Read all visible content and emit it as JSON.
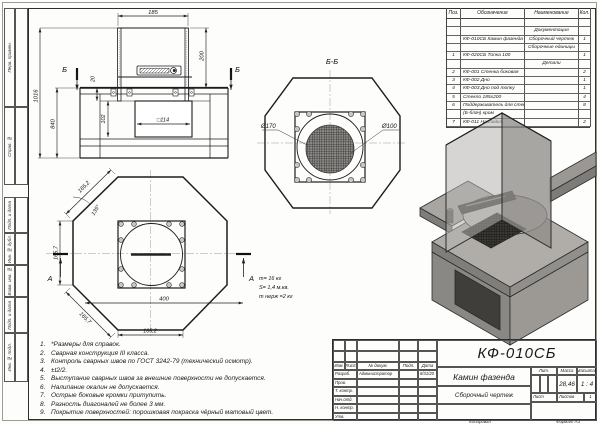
{
  "frame": {
    "left_labels": [
      "Перв. примен.",
      "Справ. №",
      "Подп. и дата",
      "Инв. № дубл.",
      "Взам. инв. №",
      "Подп. и дата",
      "Инв. № подл."
    ]
  },
  "parts_table": {
    "headers": [
      "Поз.",
      "Обозначение",
      "Наименование",
      "Кол."
    ],
    "rows": [
      {
        "poz": "",
        "oboz": "",
        "name": "",
        "qty": ""
      },
      {
        "poz": "",
        "oboz": "",
        "name": "Документация",
        "qty": ""
      },
      {
        "poz": "",
        "oboz": "КФ-010СБ Камин фазенда",
        "name": "Сборочный чертеж",
        "qty": "1"
      },
      {
        "poz": "",
        "oboz": "",
        "name": "Сборочные единицы",
        "qty": ""
      },
      {
        "poz": "1",
        "oboz": "КФ-020СБ Топка 100",
        "name": "",
        "qty": "1"
      },
      {
        "poz": "",
        "oboz": "",
        "name": "Детали",
        "qty": ""
      },
      {
        "poz": "2",
        "oboz": "КФ-001 Стенка боковая",
        "name": "",
        "qty": "2"
      },
      {
        "poz": "3",
        "oboz": "КФ-002 Дно",
        "name": "",
        "qty": "1"
      },
      {
        "poz": "4",
        "oboz": "КФ-003 Дно под топку",
        "name": "",
        "qty": "1"
      },
      {
        "poz": "5",
        "oboz": "Стекло 185х200",
        "name": "",
        "qty": "4"
      },
      {
        "poz": "6",
        "oboz": "Поддерживатель для стекла",
        "name": "",
        "qty": "8"
      },
      {
        "poz": "",
        "oboz": "(Б-блач) кром",
        "name": "",
        "qty": ""
      },
      {
        "poz": "7",
        "oboz": "КФ-011 Накладка",
        "name": "",
        "qty": "2"
      }
    ]
  },
  "views": {
    "front": {
      "dim_185": "185",
      "dim_200": "200",
      "dim_1016": "1016",
      "dim_840": "840",
      "dim_20": "20",
      "dim_102": "102",
      "dim_sq114": "□114",
      "cut_label_left": "Б",
      "cut_label_right": "Б"
    },
    "section_bb": {
      "title": "Б-Б",
      "dia_170": "Ø170",
      "dia_100": "Ø100"
    },
    "top": {
      "dim_edge_tl": "165,2",
      "angle": "135°",
      "dim_left": "165,7",
      "dim_edge_bl": "165,7",
      "dim_width": "400",
      "dim_bottom": "165,2",
      "cut_label_left": "А",
      "cut_label_right": "А"
    },
    "mass_lines": [
      "m= 16 кг",
      "S= 1,4 м.кв.",
      "m нерж =2 кг"
    ]
  },
  "notes": [
    {
      "num": "1.",
      "text": "*Размеры для справок."
    },
    {
      "num": "2.",
      "text": "Сварная конструкция III класса."
    },
    {
      "num": "3.",
      "text": "Контроль сварных швов по ГОСТ 3242-79 (технический осмотр)."
    },
    {
      "num": "4.",
      "text": "±t2/2."
    },
    {
      "num": "5.",
      "text": "Выступание сварных швов за внешние поверхности не допускается."
    },
    {
      "num": "6.",
      "text": "Налипание окалин не допускается."
    },
    {
      "num": "7.",
      "text": "Острые боковые кромки притупить."
    },
    {
      "num": "8.",
      "text": "Разность диагоналей не более 3 мм."
    },
    {
      "num": "9.",
      "text": "Покрытие поверхностей: порошковая покраска чёрный матовый цвет."
    }
  ],
  "title_block": {
    "doc_number": "КФ-010СБ",
    "product_name": "Камин фазенда",
    "doc_type": "Сборочный чертеж",
    "lit_label": "Лит.",
    "mass_label": "Масса",
    "scale_label": "Масштаб",
    "mass_value": "28,46",
    "scale_value": "1 : 4",
    "sheet_label": "Лист",
    "sheets_label": "Листов",
    "sheets_value": "1",
    "change_header": {
      "izm": "Изм.",
      "list": "Лист",
      "doc": "№ докум.",
      "sign": "Подп.",
      "date": "Дата"
    },
    "staff": [
      {
        "role": "Разраб.",
        "name": "Администратор",
        "date": "8/31/20"
      },
      {
        "role": "Пров.",
        "name": "",
        "date": ""
      },
      {
        "role": "Т. контр.",
        "name": "",
        "date": ""
      },
      {
        "role": "Нач.отд.",
        "name": "",
        "date": ""
      },
      {
        "role": "Н. контр.",
        "name": "",
        "date": ""
      },
      {
        "role": "Утв.",
        "name": "",
        "date": ""
      }
    ]
  },
  "footer": {
    "copied": "Копировал",
    "format": "Формат А3"
  }
}
